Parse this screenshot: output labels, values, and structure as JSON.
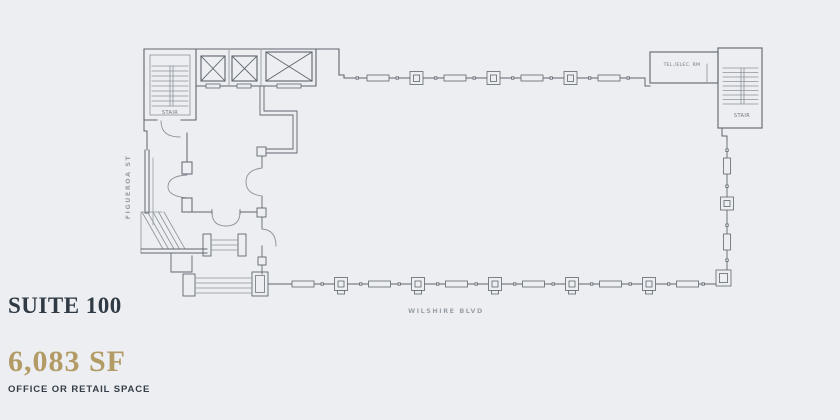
{
  "page": {
    "background": "#eceef1"
  },
  "panel": {
    "suite_title": "SUITE 100",
    "area": "6,083 SF",
    "descriptor": "OFFICE OR RETAIL SPACE",
    "title_color": "#2f3a45",
    "area_color": "#b39b66"
  },
  "floorplan": {
    "line_color": "#5f666e",
    "light_line_color": "#8d939b",
    "labels": {
      "stair_left": "STAIR",
      "stair_right": "STAIR",
      "tel_elec_room": "TEL./ELEC. RM",
      "street_west": "FIGUEROA ST",
      "street_south": "WILSHIRE BLVD"
    }
  }
}
